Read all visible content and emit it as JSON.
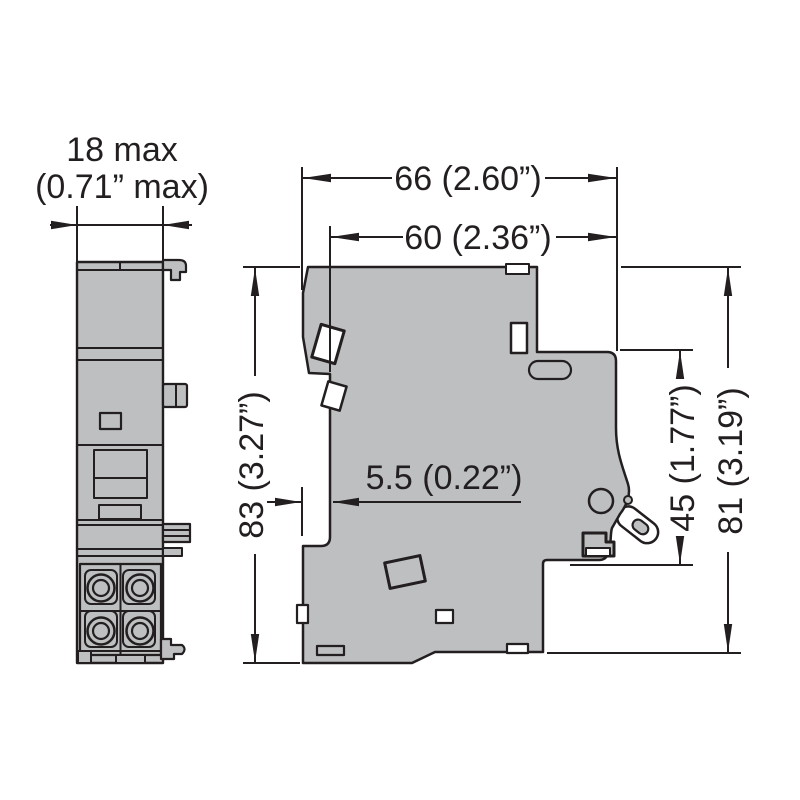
{
  "document": {
    "type": "technical dimension drawing",
    "subject": "modular circuit breaker side profile with auxiliary contact front view"
  },
  "colors": {
    "background": "#ffffff",
    "body_fill": "#bdbfc1",
    "line": "#231f20",
    "detail_fill": "#ffffff"
  },
  "front_view": {
    "name": "auxiliary contact module, front view",
    "width_label_line1": "18 max",
    "width_label_line2": "(0.71” max)"
  },
  "side_view": {
    "name": "circuit breaker, side view",
    "depth_overall": "66 (2.60”)",
    "depth_body": "60 (2.36”)",
    "height_overall": "83 (3.27”)",
    "rail_offset": "5.5 (0.22”)",
    "height_front": "45 (1.77”)",
    "height_right": "81 (3.19”)"
  }
}
